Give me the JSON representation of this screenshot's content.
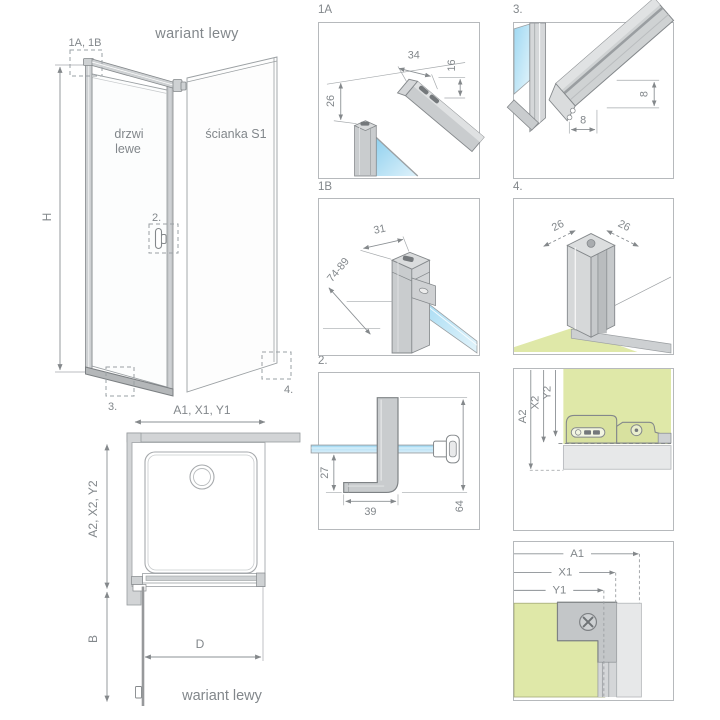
{
  "colors": {
    "glass_blue": "#9ed8f2",
    "glass_blue_light": "#e3f4fb",
    "profile_gray": "#c9ccce",
    "outline_gray": "#84888b",
    "floor_green": "#dfe8a8",
    "band_gray": "#e7e8e9",
    "text_gray": "#82878b"
  },
  "overview": {
    "title": "wariant lewy",
    "height_label": "H",
    "door_label_line1": "drzwi",
    "door_label_line2": "lewe",
    "wall_label": "ścianka S1",
    "callout_top": "1A, 1B",
    "callout_handle": "2.",
    "callout_seal": "3.",
    "callout_corner": "4.",
    "width_label": "A1, X1, Y1"
  },
  "plan": {
    "depth_label": "A2, X2, Y2",
    "door_extension_label": "B",
    "door_width_label": "D",
    "footer": "wariant lewy"
  },
  "details": {
    "d1a": {
      "label": "1A",
      "dim_top_width": "34",
      "dim_top_depth": "16",
      "dim_drop": "26"
    },
    "d1b": {
      "label": "1B",
      "dim_width": "31",
      "dim_adjust_range": "74-89"
    },
    "d2": {
      "label": "2.",
      "dim_glass_to_foot": "27",
      "dim_foot_length": "39",
      "dim_handle_length": "64"
    },
    "d3": {
      "label": "3.",
      "dim_seal_width": "8",
      "dim_seal_height": "8"
    },
    "d4": {
      "label": "4.",
      "dim_side_left": "26",
      "dim_side_right": "26"
    },
    "da2": {
      "dim_a2": "A2",
      "dim_x2": "X2",
      "dim_y2": "Y2"
    },
    "da1": {
      "dim_a1": "A1",
      "dim_x1": "X1",
      "dim_y1": "Y1"
    }
  }
}
